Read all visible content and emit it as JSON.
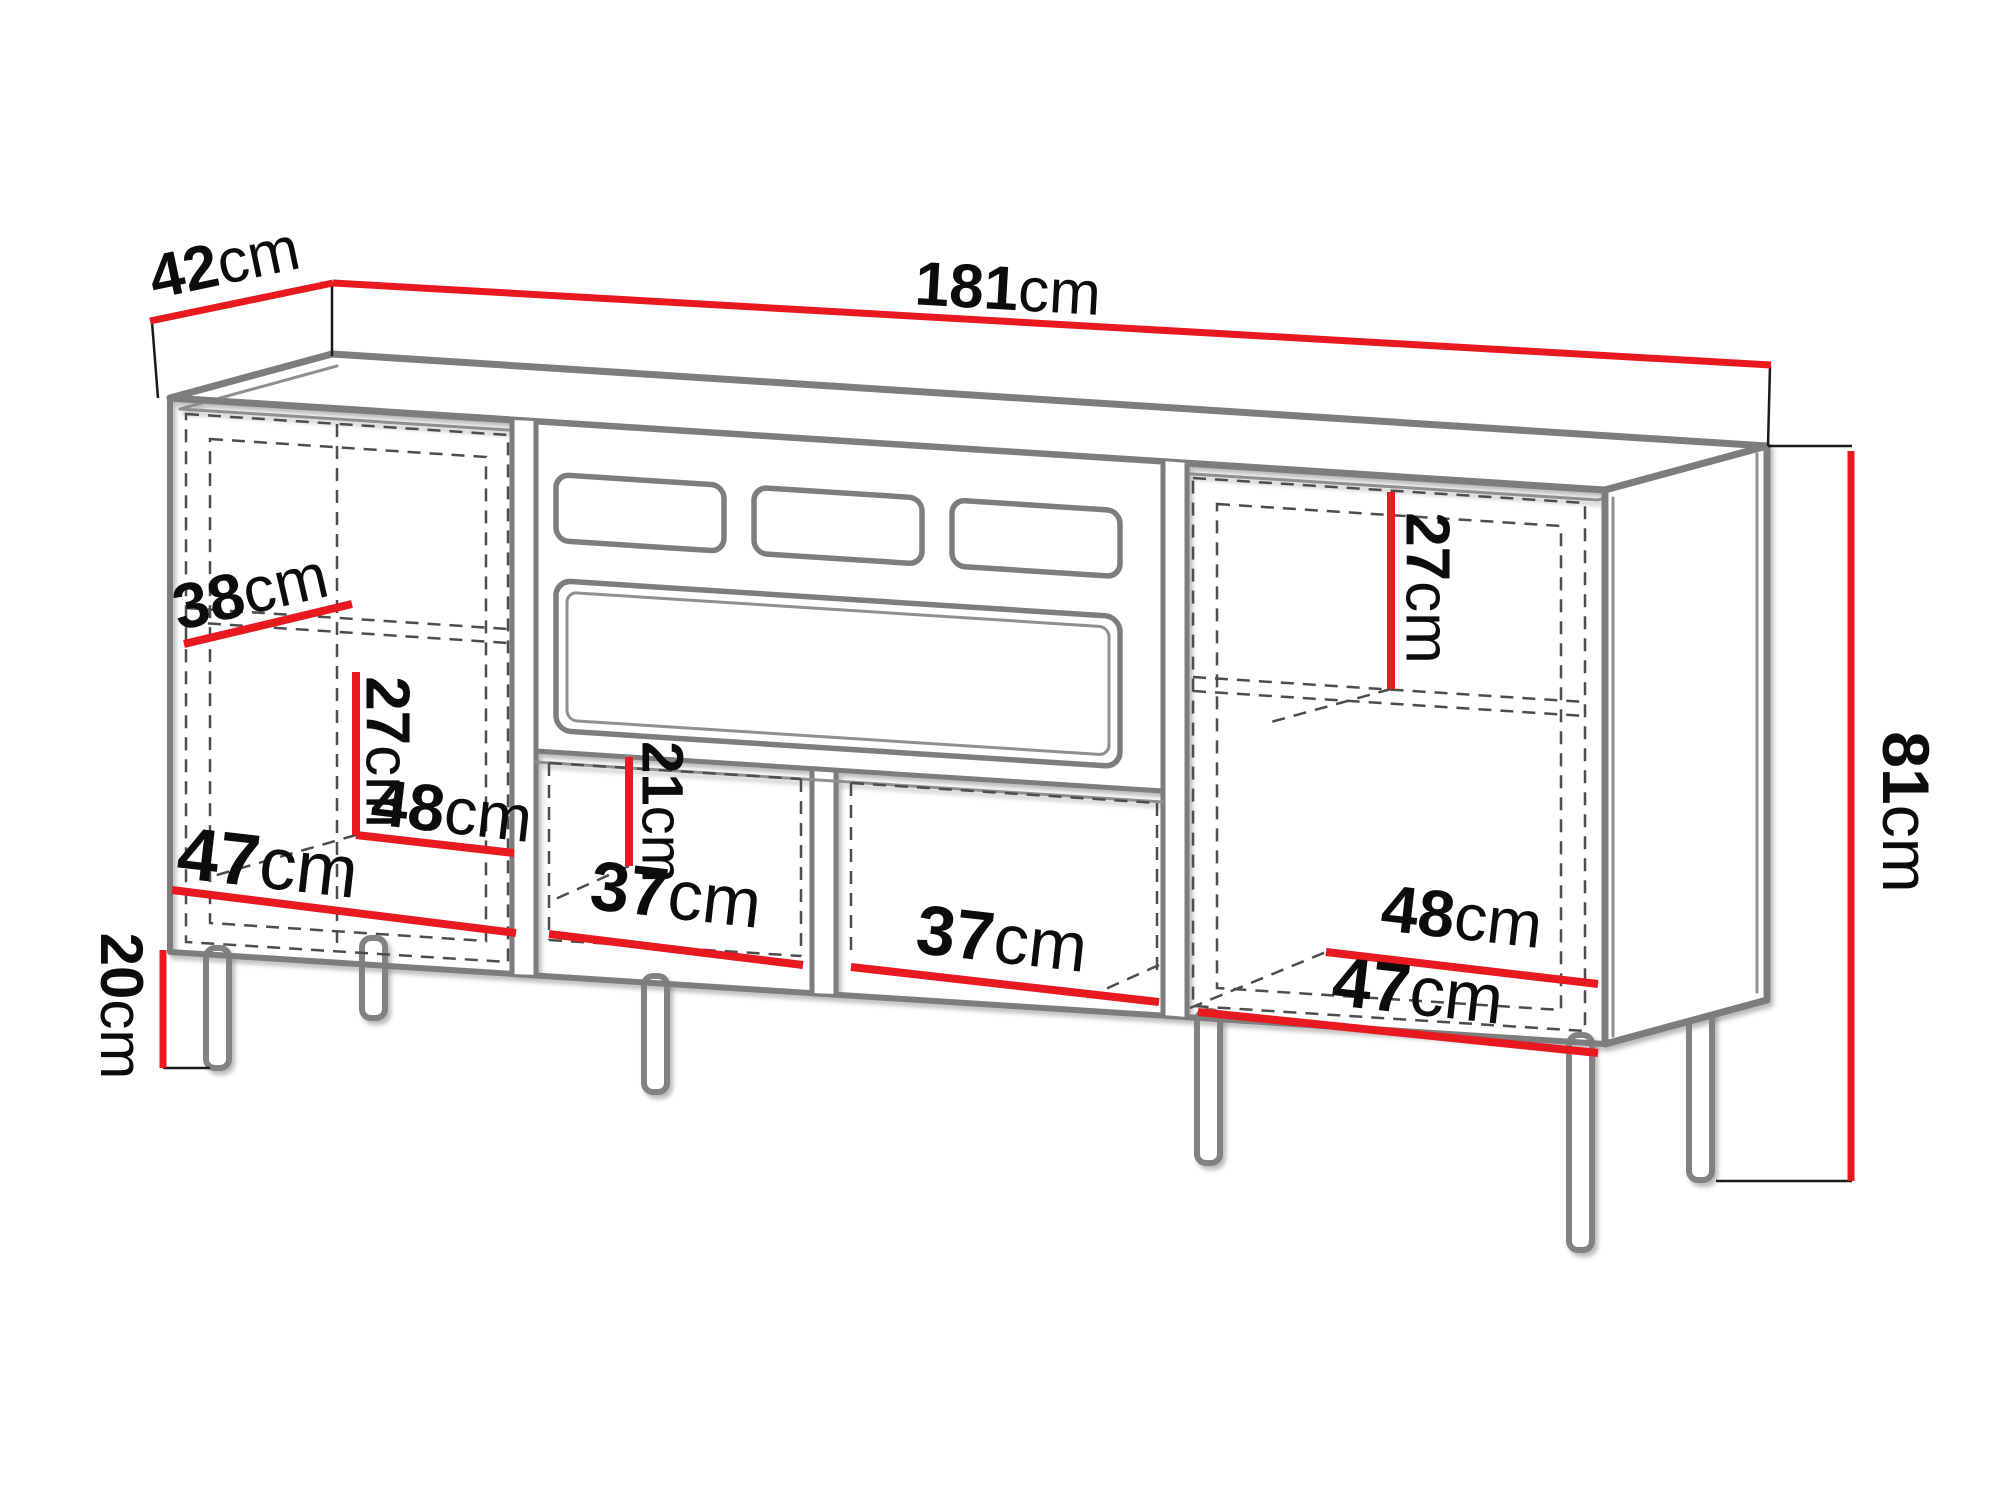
{
  "diagram": {
    "kind": "furniture-dimension-diagram",
    "unit": "cm",
    "overall": {
      "depth": {
        "num": "42",
        "unit": "cm"
      },
      "width": {
        "num": "181",
        "unit": "cm"
      },
      "height": {
        "num": "81",
        "unit": "cm"
      },
      "leg_height": {
        "num": "20",
        "unit": "cm"
      }
    },
    "interior": {
      "left_shelf_depth": {
        "num": "38",
        "unit": "cm"
      },
      "left_lower_height": {
        "num": "27",
        "unit": "cm"
      },
      "left_shelf_width": {
        "num": "48",
        "unit": "cm"
      },
      "left_floor_width": {
        "num": "47",
        "unit": "cm"
      },
      "mid_open_height": {
        "num": "21",
        "unit": "cm"
      },
      "mid_left_width": {
        "num": "37",
        "unit": "cm"
      },
      "mid_right_width": {
        "num": "37",
        "unit": "cm"
      },
      "right_upper_height": {
        "num": "27",
        "unit": "cm"
      },
      "right_shelf_width": {
        "num": "48",
        "unit": "cm"
      },
      "right_floor_width": {
        "num": "47",
        "unit": "cm"
      }
    },
    "colors": {
      "dimension_red": "#e8191f",
      "outline_gray": "#7d7d7d",
      "dashed_gray": "#4d4d4d",
      "text_black": "#0c0c0c",
      "background": "#ffffff"
    }
  }
}
